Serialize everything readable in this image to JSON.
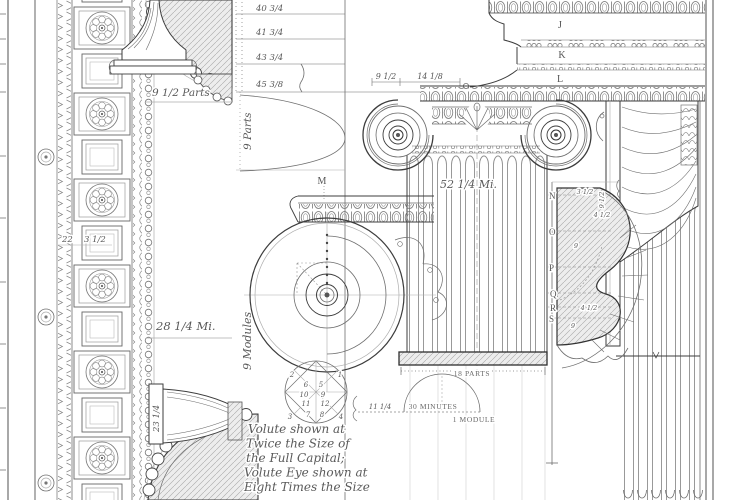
{
  "plate": {
    "palette": {
      "ink": "#3d3d3d",
      "paper": "#ffffff"
    },
    "soffit": {
      "parts_label": "9 1/2 Parts",
      "dim_a": "22",
      "dim_b": "3 1/2",
      "height_label": "28 1/4 Mi.",
      "bracket_dim": "23 1/4"
    },
    "scale_column": {
      "ticks": [
        "40 3/4",
        "41 3/4",
        "43 3/4",
        "45 3/8"
      ],
      "parts_label": "9 Parts",
      "modules_label": "9 Modules"
    },
    "entablature": {
      "letter_j": "J",
      "letter_k": "K",
      "letter_l": "L"
    },
    "capital": {
      "letter_m": "M",
      "dim_left": "9 1/2",
      "dim_right": "14 1/8",
      "shaft_label": "52 1/4 Mi."
    },
    "section": {
      "letter_n": "N",
      "letter_o": "O",
      "letter_p": "P",
      "letter_q": "Q",
      "letter_r": "R",
      "letter_s": "S",
      "dim_1": "3 1/2",
      "dim_2": "4 1/2",
      "dim_3": "9",
      "dim_4": "4 1/2",
      "dim_5": "9",
      "side_dim": "9 1/2"
    },
    "plan": {
      "parts_label": "18 PARTS",
      "minutes_label": "30 MINUTES",
      "module_label": "1 MODULE",
      "dim": "11 1/4"
    },
    "volute_eye": {
      "n1": "1",
      "n2": "2",
      "n3": "3",
      "n4": "4",
      "n5": "5",
      "n6": "6",
      "n7": "7",
      "n8": "8",
      "n9": "9",
      "n10": "10",
      "n11": "11",
      "n12": "12"
    },
    "caption": {
      "line1": "Volute shown at",
      "line2": "Twice the Size of",
      "line3": "the Full Capital;",
      "line4": "Volute Eye shown at",
      "line5": "Eight Times the Size"
    }
  }
}
